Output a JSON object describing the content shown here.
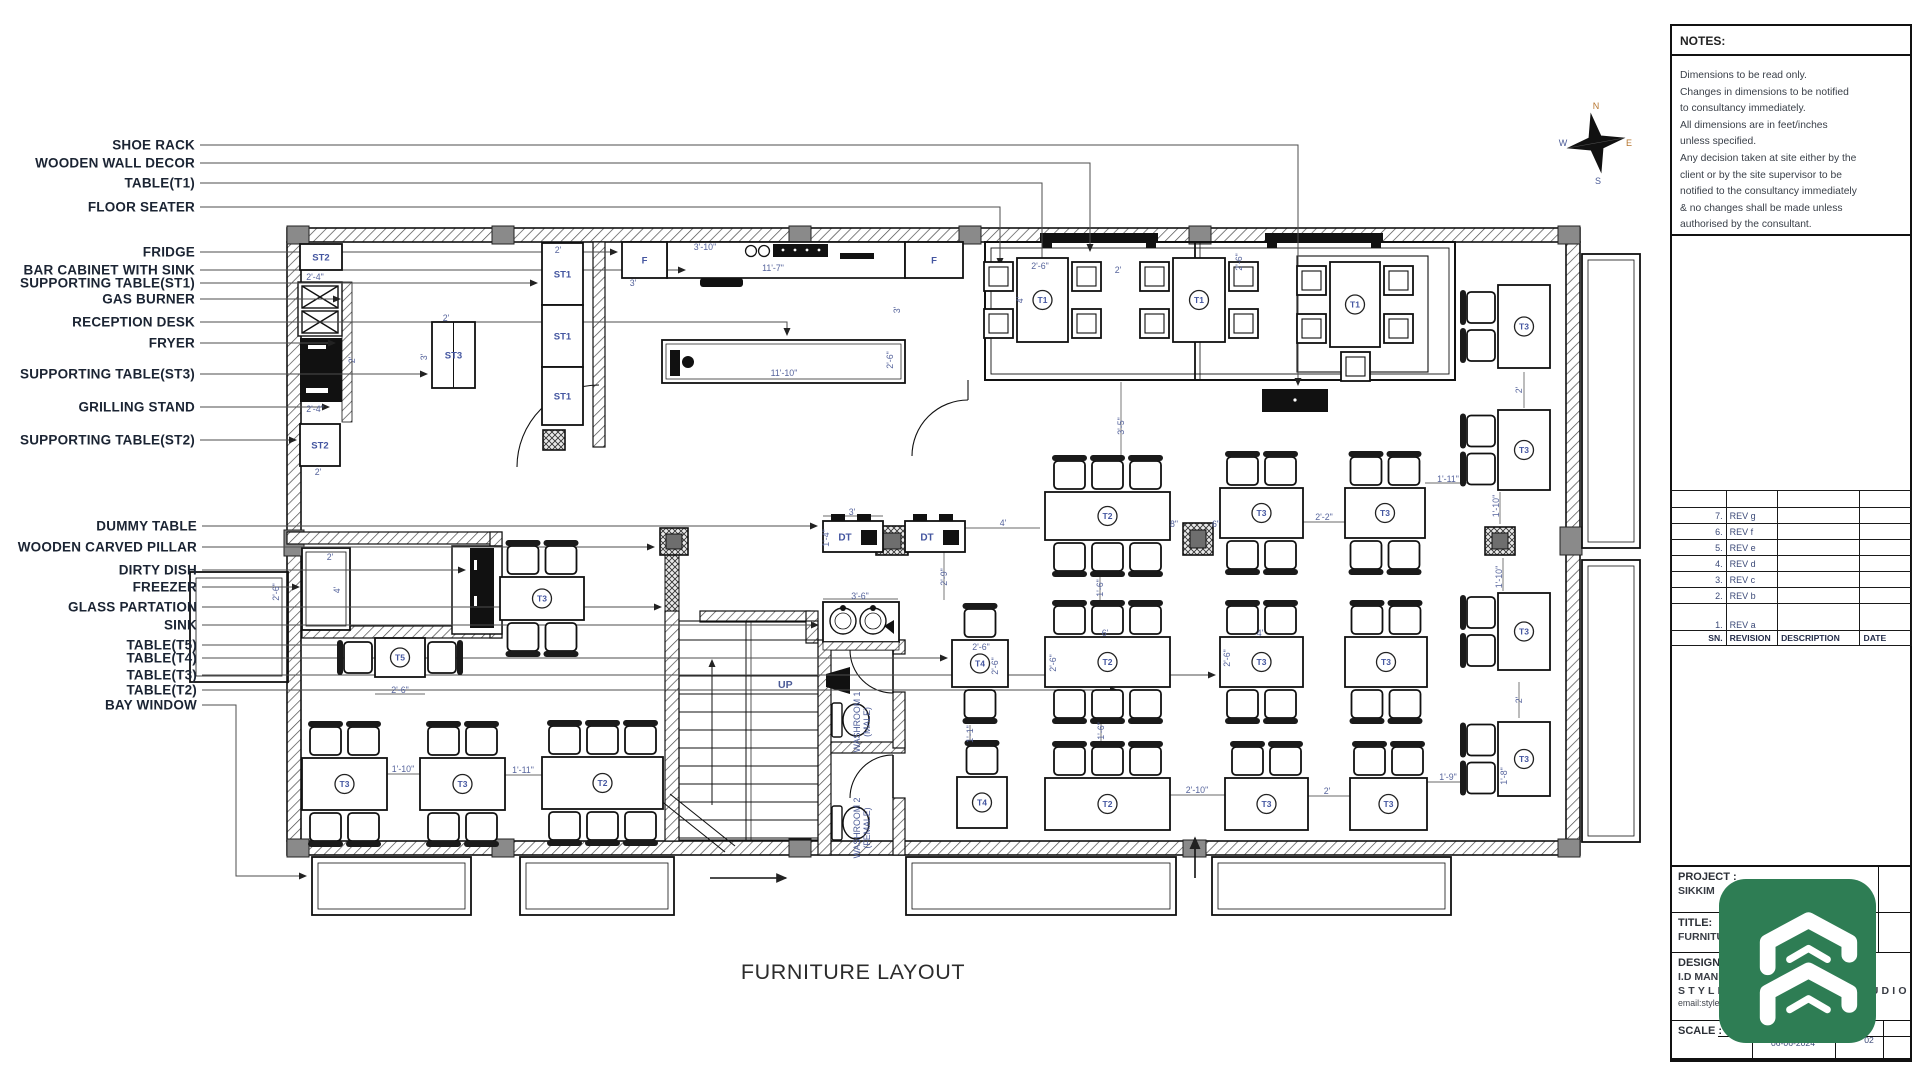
{
  "sheet": {
    "drawing_title": "FURNITURE LAYOUT"
  },
  "compass": {
    "n": "N",
    "e": "E",
    "s": "S",
    "w": "W"
  },
  "notes": {
    "header": "NOTES:",
    "lines": [
      "Dimensions to be read only.",
      "Changes in dimensions to be notified",
      "to consultancy immediately.",
      "All dimensions are in feet/inches",
      "unless specified.",
      "Any decision taken at site either by the",
      "client or by the site supervisor to be",
      "notified to the consultancy immediately",
      "& no changes shall be made unless",
      "authorised by the consultant."
    ]
  },
  "revisions": {
    "rows": [
      {
        "sn": "7.",
        "rev": "REV g",
        "desc": "",
        "date": ""
      },
      {
        "sn": "6.",
        "rev": "REV f",
        "desc": "",
        "date": ""
      },
      {
        "sn": "5.",
        "rev": "REV e",
        "desc": "",
        "date": ""
      },
      {
        "sn": "4.",
        "rev": "REV d",
        "desc": "",
        "date": ""
      },
      {
        "sn": "3.",
        "rev": "REV c",
        "desc": "",
        "date": ""
      },
      {
        "sn": "2.",
        "rev": "REV b",
        "desc": "",
        "date": ""
      },
      {
        "sn": "1.",
        "rev": "REV a",
        "desc": "",
        "date": ""
      }
    ],
    "footer": {
      "sn": "SN.",
      "revision": "REVISION",
      "description": "DESCRIPTION",
      "date": "DATE"
    }
  },
  "title_block": {
    "project_label": "PROJECT :",
    "project_value": "SIKKIM",
    "title_label": "TITLE:",
    "title_value": "FURNITURE LAYOUT",
    "designed_by": "DESIGNED BY :",
    "designer": "I.D MANISH",
    "studio": "STYLESPACE DESIGN STUDIO",
    "email": "email:stylespacedesignstudio@gmail.com",
    "scale_label": "SCALE :",
    "date": "06-06-2024",
    "sheet_no": "02"
  },
  "plan": {
    "room_labels": {
      "up": "UP",
      "washroom1": "WASHROOM 1",
      "washroom1_sub": "(MALE)",
      "washroom2": "WASHROOM 2",
      "washroom2_sub": "(FEMALE)"
    },
    "callouts": [
      {
        "label": "SHOE RACK",
        "x": 195,
        "y": 145,
        "pts": [
          [
            200,
            145
          ],
          [
            1298,
            145
          ],
          [
            1298,
            385
          ]
        ]
      },
      {
        "label": "WOODEN WALL DECOR",
        "x": 195,
        "y": 163,
        "pts": [
          [
            200,
            163
          ],
          [
            1090,
            163
          ],
          [
            1090,
            251
          ]
        ]
      },
      {
        "label": "TABLE(T1)",
        "x": 195,
        "y": 183,
        "pts": [
          [
            200,
            183
          ],
          [
            1042,
            183
          ],
          [
            1042,
            275
          ]
        ]
      },
      {
        "label": "FLOOR SEATER",
        "x": 195,
        "y": 207,
        "pts": [
          [
            200,
            207
          ],
          [
            1000,
            207
          ],
          [
            1000,
            265
          ]
        ]
      },
      {
        "label": "FRIDGE",
        "x": 195,
        "y": 252,
        "pts": [
          [
            200,
            252
          ],
          [
            617,
            252
          ]
        ]
      },
      {
        "label": "BAR CABINET WITH SINK",
        "x": 195,
        "y": 270,
        "pts": [
          [
            200,
            270
          ],
          [
            685,
            270
          ]
        ]
      },
      {
        "label": "SUPPORTING TABLE(ST1)",
        "x": 195,
        "y": 283,
        "pts": [
          [
            200,
            283
          ],
          [
            537,
            283
          ]
        ]
      },
      {
        "label": "GAS BURNER",
        "x": 195,
        "y": 299,
        "pts": [
          [
            200,
            299
          ],
          [
            340,
            299
          ]
        ]
      },
      {
        "label": "RECEPTION DESK",
        "x": 195,
        "y": 322,
        "pts": [
          [
            200,
            322
          ],
          [
            787,
            322
          ],
          [
            787,
            335
          ]
        ]
      },
      {
        "label": "FRYER",
        "x": 195,
        "y": 343,
        "pts": [
          [
            200,
            343
          ],
          [
            335,
            343
          ]
        ]
      },
      {
        "label": "SUPPORTING TABLE(ST3)",
        "x": 195,
        "y": 374,
        "pts": [
          [
            200,
            374
          ],
          [
            427,
            374
          ]
        ]
      },
      {
        "label": "GRILLING STAND",
        "x": 195,
        "y": 407,
        "pts": [
          [
            200,
            407
          ],
          [
            329,
            407
          ]
        ]
      },
      {
        "label": "SUPPORTING TABLE(ST2)",
        "x": 195,
        "y": 440,
        "pts": [
          [
            200,
            440
          ],
          [
            296,
            440
          ]
        ]
      },
      {
        "label": "DUMMY TABLE",
        "x": 197,
        "y": 526,
        "pts": [
          [
            202,
            526
          ],
          [
            817,
            526
          ]
        ]
      },
      {
        "label": "WOODEN CARVED PILLAR",
        "x": 197,
        "y": 547,
        "pts": [
          [
            202,
            547
          ],
          [
            654,
            547
          ]
        ]
      },
      {
        "label": "DIRTY DISH",
        "x": 197,
        "y": 570,
        "pts": [
          [
            202,
            570
          ],
          [
            465,
            570
          ]
        ]
      },
      {
        "label": "FREEZER",
        "x": 197,
        "y": 587,
        "pts": [
          [
            202,
            587
          ],
          [
            299,
            587
          ]
        ]
      },
      {
        "label": "GLASS PARTATION",
        "x": 197,
        "y": 607,
        "pts": [
          [
            202,
            607
          ],
          [
            661,
            607
          ]
        ]
      },
      {
        "label": "SINK",
        "x": 197,
        "y": 625,
        "pts": [
          [
            202,
            625
          ],
          [
            818,
            625
          ]
        ]
      },
      {
        "label": "TABLE(T5)",
        "x": 197,
        "y": 645,
        "pts": [
          [
            202,
            645
          ],
          [
            371,
            645
          ]
        ]
      },
      {
        "label": "TABLE(T4)",
        "x": 197,
        "y": 658,
        "pts": [
          [
            202,
            658
          ],
          [
            947,
            658
          ]
        ]
      },
      {
        "label": "TABLE(T3)",
        "x": 197,
        "y": 675,
        "pts": [
          [
            202,
            675
          ],
          [
            1215,
            675
          ]
        ]
      },
      {
        "label": "TABLE(T2)",
        "x": 197,
        "y": 690,
        "pts": [
          [
            202,
            690
          ],
          [
            1117,
            690
          ]
        ]
      },
      {
        "label": "BAY WINDOW",
        "x": 197,
        "y": 705,
        "pts": [
          [
            202,
            705
          ],
          [
            236,
            705
          ],
          [
            236,
            876
          ],
          [
            306,
            876
          ]
        ]
      }
    ],
    "tables": [
      {
        "label": "T1",
        "x": 1017,
        "y": 258,
        "w": 51,
        "h": 84,
        "cushions": {
          "left": 2,
          "right": 2
        }
      },
      {
        "label": "T1",
        "x": 1173,
        "y": 258,
        "w": 52,
        "h": 84,
        "cushions": {
          "left": 2,
          "right": 2
        }
      },
      {
        "label": "T1",
        "x": 1330,
        "y": 262,
        "w": 50,
        "h": 85,
        "cushions": {
          "left": 2,
          "right": 2,
          "bottom": 1
        }
      },
      {
        "label": "T2",
        "x": 1045,
        "y": 492,
        "w": 125,
        "h": 48,
        "chairs": {
          "top": 3,
          "bottom": 3
        }
      },
      {
        "label": "T3",
        "x": 1220,
        "y": 488,
        "w": 83,
        "h": 50,
        "chairs": {
          "top": 2,
          "bottom": 2
        }
      },
      {
        "label": "T3",
        "x": 1345,
        "y": 488,
        "w": 80,
        "h": 50,
        "chairs": {
          "top": 2,
          "bottom": 2
        }
      },
      {
        "label": "T2",
        "x": 1045,
        "y": 637,
        "w": 125,
        "h": 50,
        "chairs": {
          "top": 3,
          "bottom": 3
        }
      },
      {
        "label": "T3",
        "x": 1220,
        "y": 637,
        "w": 83,
        "h": 50,
        "chairs": {
          "top": 2,
          "bottom": 2
        }
      },
      {
        "label": "T3",
        "x": 1345,
        "y": 637,
        "w": 82,
        "h": 50,
        "chairs": {
          "top": 2,
          "bottom": 2
        }
      },
      {
        "label": "T4",
        "x": 952,
        "y": 640,
        "w": 56,
        "h": 47,
        "chairs": {
          "top": 1,
          "bottom": 1
        }
      },
      {
        "label": "T4",
        "x": 957,
        "y": 777,
        "w": 50,
        "h": 51,
        "chairs": {
          "top": 1
        }
      },
      {
        "label": "T2",
        "x": 1045,
        "y": 778,
        "w": 125,
        "h": 52,
        "chairs": {
          "top": 3
        }
      },
      {
        "label": "T3",
        "x": 1225,
        "y": 778,
        "w": 83,
        "h": 52,
        "chairs": {
          "top": 2
        }
      },
      {
        "label": "T3",
        "x": 1350,
        "y": 778,
        "w": 77,
        "h": 52,
        "chairs": {
          "top": 2
        }
      },
      {
        "label": "T3",
        "x": 302,
        "y": 758,
        "w": 85,
        "h": 52,
        "chairs": {
          "top": 2,
          "bottom": 2
        }
      },
      {
        "label": "T3",
        "x": 420,
        "y": 758,
        "w": 85,
        "h": 52,
        "chairs": {
          "top": 2,
          "bottom": 2
        }
      },
      {
        "label": "T2",
        "x": 542,
        "y": 757,
        "w": 121,
        "h": 52,
        "chairs": {
          "top": 3,
          "bottom": 3
        }
      },
      {
        "label": "T5",
        "x": 375,
        "y": 638,
        "w": 50,
        "h": 39,
        "chairs": {
          "left": 1,
          "right": 1
        }
      },
      {
        "label": "T3",
        "x": 500,
        "y": 577,
        "w": 84,
        "h": 43,
        "chairs": {
          "top": 2,
          "bottom": 2
        }
      },
      {
        "label": "T3",
        "x": 1498,
        "y": 285,
        "w": 52,
        "h": 83,
        "chairs": {
          "left": 2
        }
      },
      {
        "label": "T3",
        "x": 1498,
        "y": 410,
        "w": 52,
        "h": 80,
        "chairs": {
          "left": 2
        }
      },
      {
        "label": "T3",
        "x": 1498,
        "y": 593,
        "w": 52,
        "h": 77,
        "chairs": {
          "left": 2
        }
      },
      {
        "label": "T3",
        "x": 1498,
        "y": 722,
        "w": 52,
        "h": 74,
        "chairs": {
          "left": 2
        }
      },
      {
        "label": "DT",
        "x": 823,
        "y": 521,
        "w": 60,
        "h": 31,
        "shape": "dt"
      },
      {
        "label": "DT",
        "x": 905,
        "y": 521,
        "w": 60,
        "h": 31,
        "shape": "dt"
      },
      {
        "label": "ST2",
        "x": 300,
        "y": 244,
        "w": 42,
        "h": 26,
        "shape": "plain"
      },
      {
        "label": "ST2",
        "x": 300,
        "y": 424,
        "w": 40,
        "h": 42,
        "shape": "plain"
      },
      {
        "label": "ST3",
        "x": 432,
        "y": 322,
        "w": 43,
        "h": 66,
        "shape": "plain",
        "divider": true
      },
      {
        "label": "ST1",
        "x": 542,
        "y": 243,
        "w": 41,
        "h": 62,
        "shape": "plain"
      },
      {
        "label": "ST1",
        "x": 542,
        "y": 305,
        "w": 41,
        "h": 62,
        "shape": "plain"
      },
      {
        "label": "ST1",
        "x": 542,
        "y": 367,
        "w": 41,
        "h": 58,
        "shape": "plain"
      },
      {
        "label": "F",
        "x": 622,
        "y": 242,
        "w": 45,
        "h": 36,
        "shape": "plain"
      },
      {
        "label": "F",
        "x": 905,
        "y": 242,
        "w": 58,
        "h": 36,
        "shape": "plain"
      }
    ],
    "dims": [
      {
        "t": "2'-4\"",
        "x": 315,
        "y": 277
      },
      {
        "t": "2'",
        "x": 558,
        "y": 250
      },
      {
        "t": "3'-10\"",
        "x": 705,
        "y": 247
      },
      {
        "t": "11'-7\"",
        "x": 773,
        "y": 268
      },
      {
        "t": "3'",
        "x": 633,
        "y": 283
      },
      {
        "t": "2'",
        "x": 446,
        "y": 318
      },
      {
        "t": "3'",
        "x": 424,
        "y": 357,
        "r": -90
      },
      {
        "t": "2'",
        "x": 352,
        "y": 360,
        "r": -90
      },
      {
        "t": "2'-4\"",
        "x": 315,
        "y": 409
      },
      {
        "t": "2'",
        "x": 318,
        "y": 472
      },
      {
        "t": "2'",
        "x": 330,
        "y": 557
      },
      {
        "t": "4'",
        "x": 337,
        "y": 590,
        "r": -90
      },
      {
        "t": "11'-10\"",
        "x": 784,
        "y": 373
      },
      {
        "t": "2'-6\"",
        "x": 890,
        "y": 360,
        "r": -90
      },
      {
        "t": "3'",
        "x": 897,
        "y": 310,
        "r": -90
      },
      {
        "t": "2'-6\"",
        "x": 1040,
        "y": 266
      },
      {
        "t": "2'",
        "x": 1118,
        "y": 270
      },
      {
        "t": "4'",
        "x": 1020,
        "y": 300,
        "r": -90
      },
      {
        "t": "2'-6\"",
        "x": 1239,
        "y": 262,
        "r": -90
      },
      {
        "t": "3'-5\"",
        "x": 1121,
        "y": 426,
        "r": -90,
        "line": [
          1121,
          382,
          1121,
          456
        ]
      },
      {
        "t": "3'",
        "x": 852,
        "y": 512,
        "line": [
          823,
          516,
          883,
          516
        ]
      },
      {
        "t": "1'-4\"",
        "x": 826,
        "y": 538,
        "r": -90
      },
      {
        "t": "4'",
        "x": 1003,
        "y": 523,
        "line": [
          965,
          528,
          1040,
          528
        ]
      },
      {
        "t": "2'-9\"",
        "x": 944,
        "y": 577,
        "r": -90,
        "line": [
          944,
          552,
          944,
          600
        ]
      },
      {
        "t": "3'-6\"",
        "x": 860,
        "y": 596,
        "line": [
          823,
          599,
          898,
          599
        ]
      },
      {
        "t": "8\"",
        "x": 1174,
        "y": 524
      },
      {
        "t": "6\"",
        "x": 1216,
        "y": 524
      },
      {
        "t": "2'-2\"",
        "x": 1324,
        "y": 517,
        "line": [
          1303,
          522,
          1345,
          522
        ]
      },
      {
        "t": "1'-11\"",
        "x": 1448,
        "y": 479,
        "line": [
          1425,
          483,
          1468,
          483
        ]
      },
      {
        "t": "1'-6\"",
        "x": 1100,
        "y": 588,
        "r": -90,
        "line": [
          1100,
          574,
          1100,
          604
        ]
      },
      {
        "t": "2'-6\"",
        "x": 981,
        "y": 647
      },
      {
        "t": "2'-6\"",
        "x": 995,
        "y": 666,
        "r": -90
      },
      {
        "t": "6'",
        "x": 1105,
        "y": 633
      },
      {
        "t": "2'-6\"",
        "x": 1053,
        "y": 663,
        "r": -90
      },
      {
        "t": "4'",
        "x": 1260,
        "y": 633
      },
      {
        "t": "2'-6\"",
        "x": 1227,
        "y": 658,
        "r": -90
      },
      {
        "t": "2'",
        "x": 1519,
        "y": 390,
        "r": -90,
        "line": [
          1524,
          372,
          1524,
          408
        ]
      },
      {
        "t": "1'-10\"",
        "x": 1496,
        "y": 506,
        "r": -90,
        "line": [
          1500,
          492,
          1500,
          524
        ]
      },
      {
        "t": "1'-10\"",
        "x": 1499,
        "y": 577,
        "r": -90,
        "line": [
          1503,
          558,
          1503,
          591
        ]
      },
      {
        "t": "1'-1\"",
        "x": 970,
        "y": 734,
        "r": -90,
        "line": [
          970,
          725,
          970,
          742
        ]
      },
      {
        "t": "1'-6\"",
        "x": 1101,
        "y": 731,
        "r": -90,
        "line": [
          1101,
          721,
          1101,
          742
        ]
      },
      {
        "t": "2'-10\"",
        "x": 1197,
        "y": 790,
        "line": [
          1170,
          795,
          1225,
          795
        ]
      },
      {
        "t": "2'",
        "x": 1327,
        "y": 791,
        "line": [
          1308,
          796,
          1350,
          796
        ]
      },
      {
        "t": "1'-9\"",
        "x": 1448,
        "y": 777,
        "line": [
          1427,
          782,
          1463,
          782
        ]
      },
      {
        "t": "1'-8\"",
        "x": 1504,
        "y": 776,
        "r": -90
      },
      {
        "t": "2'",
        "x": 1519,
        "y": 700,
        "r": -90,
        "line": [
          1519,
          682,
          1519,
          718
        ]
      },
      {
        "t": "1'-10\"",
        "x": 403,
        "y": 769,
        "line": [
          387,
          774,
          420,
          774
        ]
      },
      {
        "t": "1'-11\"",
        "x": 523,
        "y": 770,
        "line": [
          505,
          775,
          542,
          775
        ]
      },
      {
        "t": "2'-6\"",
        "x": 400,
        "y": 690,
        "line": [
          375,
          694,
          425,
          694
        ]
      },
      {
        "t": "2'-6\"",
        "x": 276,
        "y": 592,
        "r": -90
      }
    ]
  }
}
